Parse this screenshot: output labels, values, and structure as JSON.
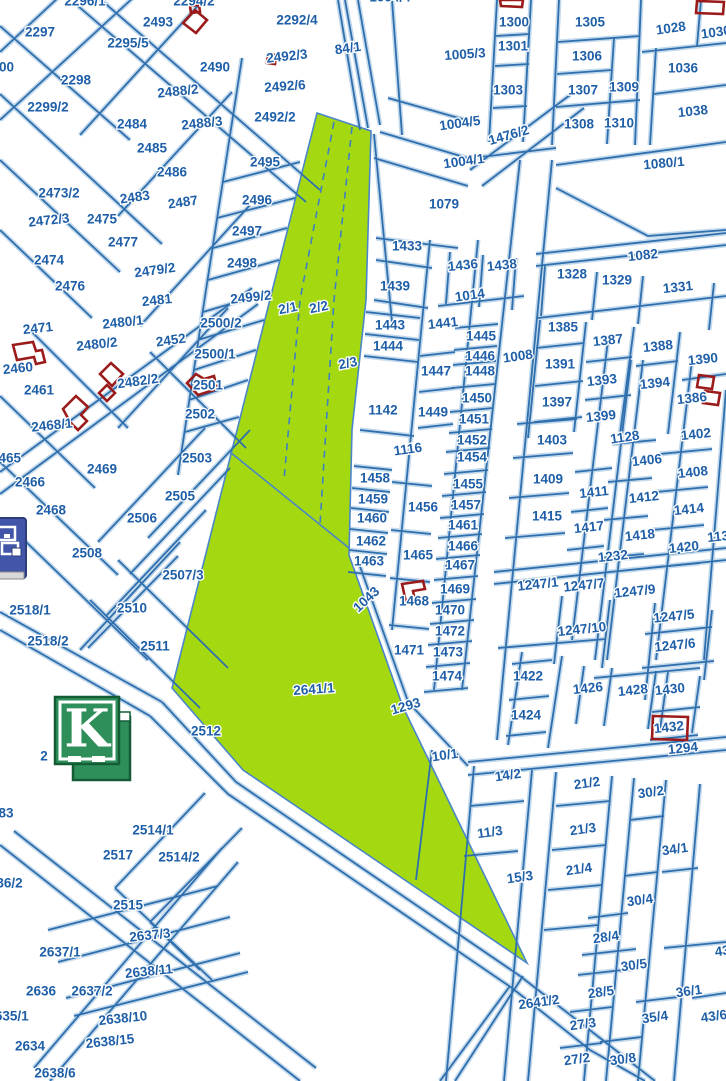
{
  "map": {
    "type": "cadastral-parcel-map",
    "background": "#ffffff",
    "colors": {
      "parcel_line": "#2f6fad",
      "line_halo": "#c3d9ec",
      "label_text": "#1f5fa8",
      "highlight_fill": "#a4d911",
      "highlight_edge": "#4a86c8",
      "building_outline": "#9b1b1b",
      "logo_green": "#2e8f5a",
      "logo_border": "#145c36",
      "icon_blue": "#4156a8"
    },
    "highlighted_parcels": [
      "2/1",
      "2/2",
      "2/3",
      "2641/1"
    ],
    "labels": [
      [
        "2296/1",
        85,
        2
      ],
      [
        "2294/2",
        194,
        2
      ],
      [
        "1004/4",
        390,
        -2
      ],
      [
        "2297",
        40,
        33
      ],
      [
        "2493",
        158,
        23
      ],
      [
        "2295/5",
        128,
        44
      ],
      [
        "2490",
        215,
        68
      ],
      [
        "2298",
        76,
        81
      ],
      [
        "2488/2",
        178,
        92,
        -6
      ],
      [
        "2299/2",
        48,
        108
      ],
      [
        "2484",
        132,
        125
      ],
      [
        "2488/3",
        202,
        124,
        -6
      ],
      [
        "2485",
        152,
        149
      ],
      [
        "2486",
        172,
        173
      ],
      [
        "2300",
        -1,
        68
      ],
      [
        "2292/4",
        297,
        21
      ],
      [
        "84/1",
        348,
        49,
        -8
      ],
      [
        "2492/3",
        287,
        57,
        -6
      ],
      [
        "2492/6",
        285,
        87,
        -4
      ],
      [
        "2492/2",
        275,
        118
      ],
      [
        "2495",
        265,
        163
      ],
      [
        "2496",
        257,
        201
      ],
      [
        "2497",
        247,
        232
      ],
      [
        "2498",
        242,
        264
      ],
      [
        "2499/2",
        251,
        298,
        -6
      ],
      [
        "2500/2",
        221,
        324
      ],
      [
        "2500/1",
        215,
        355
      ],
      [
        "2501",
        208,
        386
      ],
      [
        "2502",
        200,
        415
      ],
      [
        "2503",
        197,
        459
      ],
      [
        "2505",
        180,
        497
      ],
      [
        "2506",
        142,
        519
      ],
      [
        "2508",
        87,
        554
      ],
      [
        "2507/3",
        183,
        576
      ],
      [
        "2510",
        132,
        609
      ],
      [
        "2511",
        155,
        647
      ],
      [
        "2518/1",
        30,
        611
      ],
      [
        "2518/2",
        48,
        642
      ],
      [
        "2512",
        206,
        732
      ],
      [
        "2473/2",
        59,
        194
      ],
      [
        "2483",
        135,
        198,
        -8
      ],
      [
        "2487",
        183,
        203,
        -8
      ],
      [
        "2472/3",
        49,
        221,
        -6
      ],
      [
        "2475",
        102,
        220
      ],
      [
        "2477",
        123,
        243
      ],
      [
        "2474",
        49,
        261
      ],
      [
        "2479/2",
        155,
        271,
        -8
      ],
      [
        "2476",
        70,
        287
      ],
      [
        "2481",
        157,
        301,
        -6
      ],
      [
        "2471",
        38,
        329,
        -6
      ],
      [
        "2480/1",
        123,
        323,
        -6
      ],
      [
        "2480/2",
        97,
        345,
        -6
      ],
      [
        "2452",
        171,
        341,
        -8
      ],
      [
        "2460",
        18,
        369,
        -6
      ],
      [
        "2482/2",
        138,
        382,
        -8
      ],
      [
        "2461",
        39,
        391
      ],
      [
        "2465",
        6,
        459
      ],
      [
        "2466",
        30,
        483
      ],
      [
        "2469",
        102,
        470
      ],
      [
        "2468",
        51,
        511
      ],
      [
        "2468/1",
        52,
        426,
        -6
      ],
      [
        "2/1",
        288,
        309,
        -12
      ],
      [
        "2/2",
        319,
        308,
        -12
      ],
      [
        "2/3",
        348,
        364,
        -12
      ],
      [
        "2641/1",
        314,
        690,
        -4
      ],
      [
        "1005/3",
        465,
        55,
        -4
      ],
      [
        "1004/5",
        460,
        124,
        -8
      ],
      [
        "1004/1",
        464,
        162,
        -8
      ],
      [
        "1079",
        444,
        205
      ],
      [
        "1080/1",
        664,
        164,
        -5
      ],
      [
        "1476/2",
        509,
        136,
        -16
      ],
      [
        "1300",
        514,
        23
      ],
      [
        "1301",
        513,
        47
      ],
      [
        "1303",
        508,
        91
      ],
      [
        "1305",
        590,
        23
      ],
      [
        "1306",
        587,
        57
      ],
      [
        "1307",
        583,
        91
      ],
      [
        "1308",
        579,
        125
      ],
      [
        "1309",
        624,
        88
      ],
      [
        "1310",
        619,
        124
      ],
      [
        "1028",
        671,
        29,
        -8
      ],
      [
        "1030",
        716,
        33,
        -8
      ],
      [
        "1036",
        683,
        69
      ],
      [
        "1038",
        693,
        112,
        -6
      ],
      [
        "1433",
        407,
        247
      ],
      [
        "1436",
        463,
        266,
        -6
      ],
      [
        "1438",
        502,
        266,
        -6
      ],
      [
        "1439",
        395,
        287
      ],
      [
        "1014",
        470,
        296,
        -8
      ],
      [
        "1441",
        443,
        324,
        -6
      ],
      [
        "1443",
        390,
        326
      ],
      [
        "1444",
        388,
        347
      ],
      [
        "1445",
        481,
        337
      ],
      [
        "1446",
        480,
        357
      ],
      [
        "1447",
        436,
        372
      ],
      [
        "1448",
        480,
        372
      ],
      [
        "1449",
        433,
        413
      ],
      [
        "1450",
        477,
        399
      ],
      [
        "1451",
        474,
        420
      ],
      [
        "1452",
        472,
        441
      ],
      [
        "1082",
        643,
        256,
        -6
      ],
      [
        "1328",
        572,
        275
      ],
      [
        "1329",
        617,
        281
      ],
      [
        "1331",
        678,
        288,
        -6
      ],
      [
        "1385",
        563,
        328
      ],
      [
        "1387",
        608,
        341,
        -6
      ],
      [
        "1388",
        658,
        347,
        -6
      ],
      [
        "1390",
        703,
        360,
        -6
      ],
      [
        "1008",
        518,
        357,
        -8
      ],
      [
        "1391",
        560,
        365
      ],
      [
        "1393",
        602,
        381,
        -6
      ],
      [
        "1394",
        655,
        384,
        -6
      ],
      [
        "1386",
        692,
        399,
        -6
      ],
      [
        "1397",
        557,
        403
      ],
      [
        "1399",
        601,
        417,
        -6
      ],
      [
        "1402",
        696,
        435,
        -6
      ],
      [
        "1403",
        552,
        441
      ],
      [
        "1128",
        625,
        438,
        -8
      ],
      [
        "1406",
        647,
        461,
        -6
      ],
      [
        "1408",
        693,
        473,
        -6
      ],
      [
        "1409",
        548,
        480
      ],
      [
        "1411",
        594,
        493,
        -6
      ],
      [
        "1412",
        644,
        498,
        -6
      ],
      [
        "1414",
        689,
        510,
        -6
      ],
      [
        "1415",
        547,
        517
      ],
      [
        "1417",
        589,
        528,
        -6
      ],
      [
        "1418",
        640,
        536,
        -6
      ],
      [
        "1420",
        684,
        548,
        -6
      ],
      [
        "1130",
        722,
        537,
        -6
      ],
      [
        "1232",
        613,
        557,
        -6
      ],
      [
        "1247/1",
        538,
        585,
        -6
      ],
      [
        "1247/7",
        584,
        586,
        -6
      ],
      [
        "1247/9",
        635,
        592,
        -6
      ],
      [
        "1247/5",
        674,
        617,
        -6
      ],
      [
        "1247/10",
        582,
        630,
        -6
      ],
      [
        "1247/6",
        675,
        646,
        -6
      ],
      [
        "1142",
        383,
        411
      ],
      [
        "1116",
        408,
        450,
        -8
      ],
      [
        "1454",
        472,
        458
      ],
      [
        "1458",
        375,
        479
      ],
      [
        "1455",
        468,
        485
      ],
      [
        "1459",
        373,
        500
      ],
      [
        "1456",
        423,
        508
      ],
      [
        "1457",
        466,
        506
      ],
      [
        "1460",
        372,
        519
      ],
      [
        "1461",
        463,
        526
      ],
      [
        "1462",
        371,
        542
      ],
      [
        "1466",
        463,
        547
      ],
      [
        "1465",
        418,
        556
      ],
      [
        "1463",
        369,
        562
      ],
      [
        "1467",
        460,
        566
      ],
      [
        "1469",
        455,
        590
      ],
      [
        "1468",
        414,
        602
      ],
      [
        "1043",
        367,
        600,
        -43
      ],
      [
        "1470",
        450,
        611
      ],
      [
        "1472",
        450,
        632
      ],
      [
        "1471",
        409,
        651
      ],
      [
        "1473",
        448,
        653
      ],
      [
        "1474",
        447,
        677
      ],
      [
        "1422",
        528,
        677
      ],
      [
        "1426",
        588,
        689,
        -6
      ],
      [
        "1428",
        633,
        691,
        -6
      ],
      [
        "1430",
        670,
        690,
        -6
      ],
      [
        "1424",
        526,
        716
      ],
      [
        "1432",
        669,
        728,
        -6
      ],
      [
        "1293",
        406,
        707,
        -16
      ],
      [
        "1294",
        683,
        749,
        -6
      ],
      [
        "10/1",
        445,
        756,
        -8
      ],
      [
        "14/2",
        508,
        776,
        -8
      ],
      [
        "21/2",
        587,
        784,
        -8
      ],
      [
        "30/2",
        651,
        793,
        -8
      ],
      [
        "11/3",
        490,
        833,
        -8
      ],
      [
        "21/3",
        583,
        830,
        -8
      ],
      [
        "34/1",
        675,
        850,
        -8
      ],
      [
        "15/3",
        520,
        878,
        -8
      ],
      [
        "21/4",
        579,
        870,
        -8
      ],
      [
        "30/4",
        640,
        901,
        -8
      ],
      [
        "28/4",
        606,
        938,
        -8
      ],
      [
        "30/5",
        634,
        966,
        -8
      ],
      [
        "43/5",
        728,
        951,
        -8
      ],
      [
        "28/5",
        601,
        993,
        -8
      ],
      [
        "36/1",
        689,
        992,
        -8
      ],
      [
        "35/4",
        655,
        1018,
        -8
      ],
      [
        "43/6",
        714,
        1017,
        -8
      ],
      [
        "27/3",
        583,
        1025,
        -8
      ],
      [
        "2641/2",
        539,
        1003,
        -8
      ],
      [
        "27/2",
        577,
        1060,
        -8
      ],
      [
        "30/8",
        623,
        1060,
        -8
      ],
      [
        "2514/1",
        153,
        831
      ],
      [
        "2517",
        118,
        856
      ],
      [
        "2514/2",
        179,
        858
      ],
      [
        "2515",
        128,
        906
      ],
      [
        "2637/3",
        150,
        936,
        -6
      ],
      [
        "2637/1",
        60,
        953
      ],
      [
        "2638/11",
        149,
        972,
        -6
      ],
      [
        "2636",
        41,
        992
      ],
      [
        "2637/2",
        92,
        992
      ],
      [
        "2638/10",
        123,
        1019,
        -6
      ],
      [
        "2634",
        30,
        1047
      ],
      [
        "2638/15",
        110,
        1042,
        -6
      ],
      [
        "2638/6",
        55,
        1074
      ],
      [
        "2635/1",
        8,
        1017
      ],
      [
        "2636/2",
        2,
        884
      ],
      [
        "83",
        6,
        814
      ],
      [
        "2",
        44,
        757
      ]
    ]
  },
  "logo": {
    "letter": "K"
  },
  "window_icon": {
    "name": "window-icon"
  }
}
